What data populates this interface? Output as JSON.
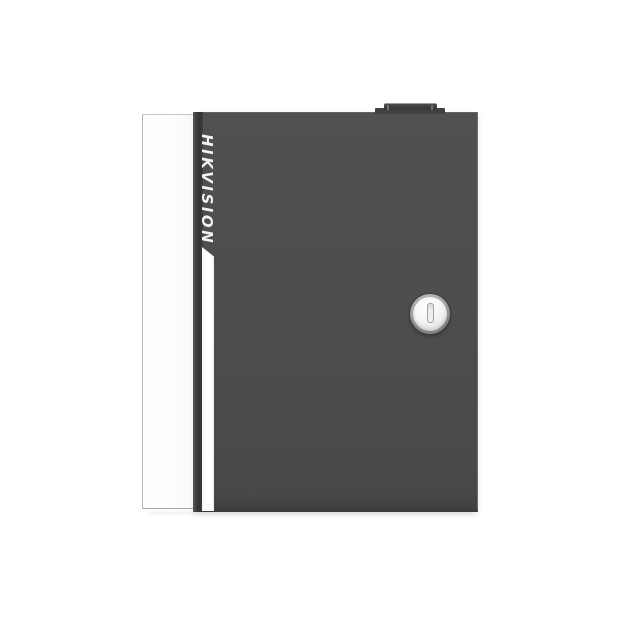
{
  "background_color": "#ffffff",
  "device": {
    "type": "access-controller-cabinet",
    "brand_label": "HIKVISION",
    "brand_text_color": "#f2f2f2",
    "door_color": "#4d4d4d",
    "side_panel_color": "#ffffff",
    "accent_stripe_color": "#ffffff",
    "hinge_shadow_color": "#383838",
    "top_knob_color": "#3c3c3c",
    "lock": {
      "icon": "keyhole-icon",
      "rim_color": "#9a9a9a",
      "face_color": "#f2f2f2",
      "keyhole_color": "#ececec"
    }
  }
}
